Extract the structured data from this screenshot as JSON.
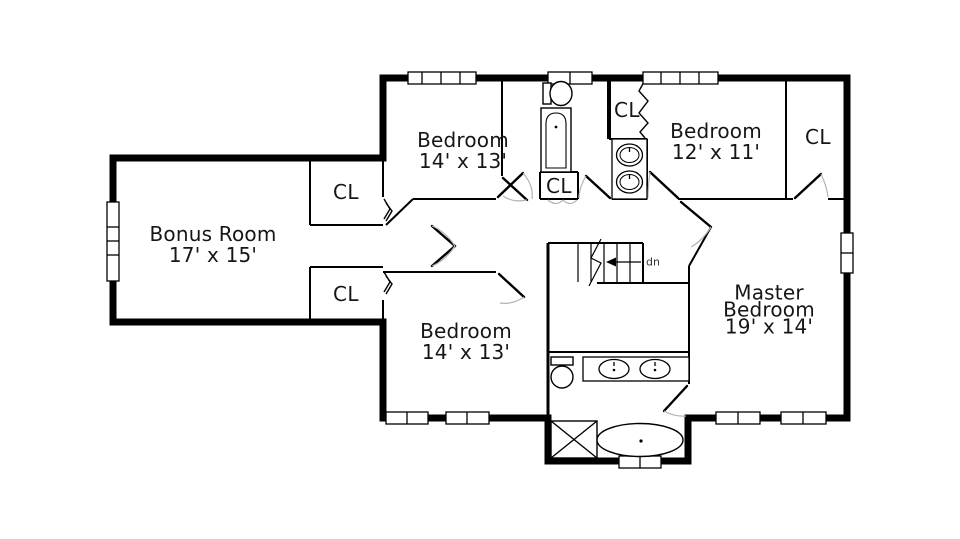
{
  "title": "Second Floor Plan",
  "colors": {
    "background": "#ffffff",
    "walls": "#000000",
    "text": "#161616",
    "door_arc": "#b3b3b3"
  },
  "floor_plan": {
    "rooms": [
      {
        "id": "bonus-room",
        "lines": [
          "Bonus Room",
          "17' x 15'"
        ]
      },
      {
        "id": "bedroom-top",
        "lines": [
          "Bedroom",
          "14' x 13'"
        ]
      },
      {
        "id": "bedroom-right",
        "lines": [
          "Bedroom",
          "12' x 11'"
        ]
      },
      {
        "id": "master-bedroom",
        "lines": [
          "Master",
          "Bedroom",
          "19' x 14'"
        ]
      },
      {
        "id": "bedroom-bottom",
        "lines": [
          "Bedroom",
          "14' x 13'"
        ]
      }
    ],
    "closets": [
      {
        "id": "closet-bonus-upper",
        "label": "CL"
      },
      {
        "id": "closet-bonus-lower",
        "label": "CL"
      },
      {
        "id": "closet-bath-linen",
        "label": "CL"
      },
      {
        "id": "closet-bedroom-right",
        "label": "CL"
      },
      {
        "id": "closet-far-right",
        "label": "CL"
      }
    ],
    "stairs": {
      "label": "dn"
    },
    "fixtures": [
      "toilet",
      "bathtub",
      "linen-closet",
      "double-sink-vanity",
      "toilet",
      "double-sink-vanity",
      "shower",
      "garden-tub",
      "staircase"
    ]
  }
}
